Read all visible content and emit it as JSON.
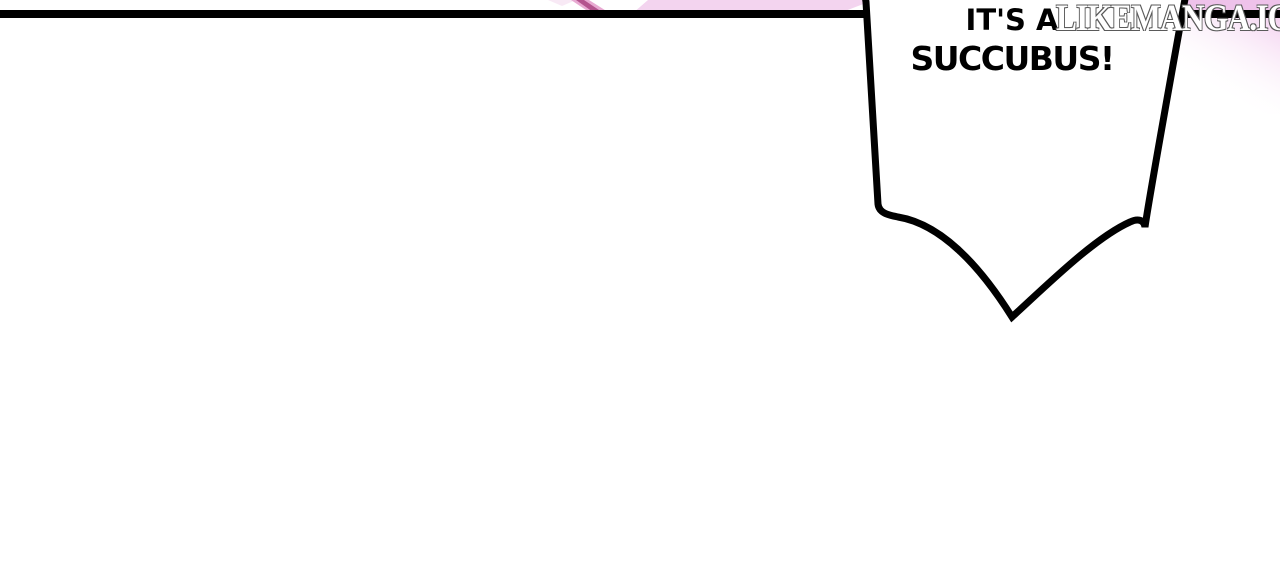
{
  "page": {
    "background": "#ffffff"
  },
  "panel": {
    "border_color": "#000000"
  },
  "bubble": {
    "line1": "IT'S A",
    "line2": "SUCCUBUS!",
    "text_color": "#000000",
    "fill": "#ffffff",
    "outline": "#000000"
  },
  "watermark": {
    "text": "LIKEMANGA.IO",
    "fill": "#ffffff",
    "outline": "#5a5a5a"
  },
  "art": {
    "pink_light": "#f3d4ef",
    "pink_faint": "#f8e9f5",
    "pink_corner": "#eec2ea",
    "corner_fade": "#f2ccee",
    "magenta_core": "#b4548e",
    "magenta_glow": "#e8aad2"
  }
}
